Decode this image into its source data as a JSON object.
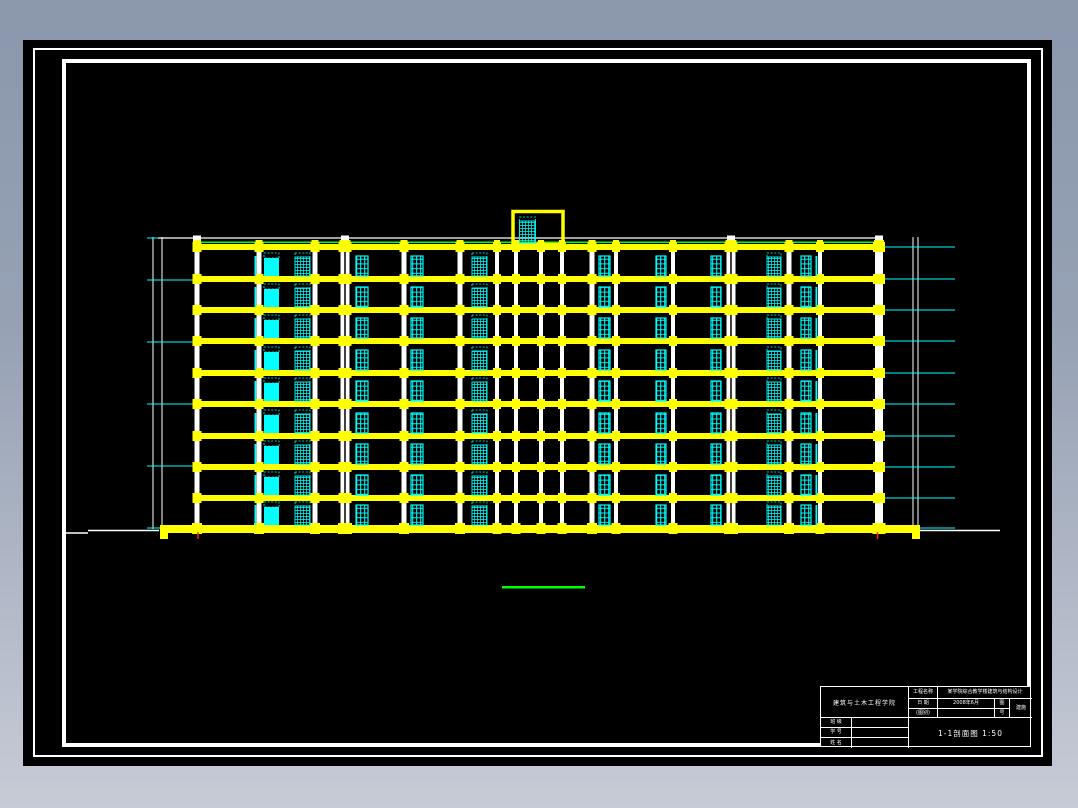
{
  "colors": {
    "yellow": "#ffff00",
    "cyan": "#00ffff",
    "green": "#00ff00",
    "white": "#ffffff",
    "red": "#ff2a00",
    "black": "#000000",
    "bg_top": "#8a97ac",
    "bg_bottom": "#c7cbd6"
  },
  "drawing": {
    "canvas": {
      "w": 1078,
      "h": 808
    },
    "body": {
      "left": 197,
      "right": 878,
      "top": 244,
      "band_h": 6,
      "band_tops": [
        244,
        276,
        307,
        338,
        370,
        401,
        433,
        464,
        495
      ]
    },
    "ground": {
      "x1": 160,
      "x2": 920,
      "top": 525,
      "h": 8,
      "cap_w": 8,
      "cap_h": 14
    },
    "columns": [
      {
        "x": 197,
        "w": 5
      },
      {
        "x": 259,
        "w": 5
      },
      {
        "x": 315,
        "w": 5
      },
      {
        "x": 345,
        "w": 9,
        "double": true
      },
      {
        "x": 404,
        "w": 5
      },
      {
        "x": 460,
        "w": 5
      },
      {
        "x": 497,
        "w": 4
      },
      {
        "x": 516,
        "w": 4
      },
      {
        "x": 541,
        "w": 4
      },
      {
        "x": 562,
        "w": 4
      },
      {
        "x": 592,
        "w": 5
      },
      {
        "x": 616,
        "w": 4
      },
      {
        "x": 673,
        "w": 4
      },
      {
        "x": 731,
        "w": 9,
        "double": true
      },
      {
        "x": 789,
        "w": 5
      },
      {
        "x": 820,
        "w": 4
      },
      {
        "x": 879,
        "w": 8
      }
    ],
    "windows": [
      {
        "x": 264,
        "w": 15,
        "t": "solid"
      },
      {
        "x": 295,
        "w": 15,
        "t": "hatch"
      },
      {
        "x": 356,
        "w": 12,
        "t": "door"
      },
      {
        "x": 411,
        "w": 12,
        "t": "door"
      },
      {
        "x": 472,
        "w": 15,
        "t": "hatch"
      },
      {
        "x": 599,
        "w": 11,
        "t": "door"
      },
      {
        "x": 656,
        "w": 10,
        "t": "door"
      },
      {
        "x": 711,
        "w": 10,
        "t": "door"
      },
      {
        "x": 767,
        "w": 14,
        "t": "hatch"
      },
      {
        "x": 801,
        "w": 10,
        "t": "door"
      }
    ],
    "thin_bars": [
      254.5,
      815.5
    ],
    "roof": {
      "white_y": 238,
      "white_x1": 158,
      "white_x2": 879,
      "green_y": 242.2,
      "posts": [
        197,
        345,
        731,
        879
      ]
    },
    "penthouse": {
      "x": 513,
      "y": 211.5,
      "w": 50,
      "h": 33,
      "win_x": 519.5,
      "win_w": 16,
      "win_top": 217
    },
    "dims": [
      {
        "vlines": [
          153,
          162
        ],
        "y1": 237,
        "y2": 529,
        "tick_x1": 147,
        "tick_x2": 197,
        "tick_ys": [
          238,
          280,
          342,
          404,
          466,
          528
        ]
      },
      {
        "vlines": [
          913,
          918
        ],
        "y1": 237,
        "y2": 529,
        "tick_x1": 879,
        "tick_x2": 955,
        "tick_ys": [
          247,
          279,
          310,
          341,
          373,
          404,
          436,
          467,
          498,
          528
        ]
      }
    ],
    "ground_lines": [
      {
        "x1": 66,
        "x2": 88,
        "y": 533
      },
      {
        "x1": 88,
        "x2": 159,
        "y": 530.5
      },
      {
        "x1": 920,
        "x2": 1000,
        "y": 530.5
      }
    ],
    "red_ticks": [
      {
        "x": 198,
        "y1": 532,
        "y2": 539
      },
      {
        "x": 877.5,
        "y1": 532,
        "y2": 539
      }
    ],
    "scale_bar": {
      "x1": 502,
      "x2": 585,
      "y": 586,
      "h": 2.5
    }
  },
  "title_block": {
    "college": "建筑与土木工程学院",
    "project_label": "工程名称",
    "project_value": "某学院综合教学楼建筑与结构设计",
    "date_label": "日  期",
    "date_value": "2008年6月",
    "tu_label": "图",
    "hao_label": "号",
    "category_label": "(图别)",
    "category_value": "",
    "scale_value": "建施",
    "class_label": "班  级",
    "class_value": "",
    "number_label": "学  号",
    "number_value": "",
    "name_label": "姓  名",
    "name_value": "",
    "drawing_title": "1-1剖面图  1:50"
  }
}
